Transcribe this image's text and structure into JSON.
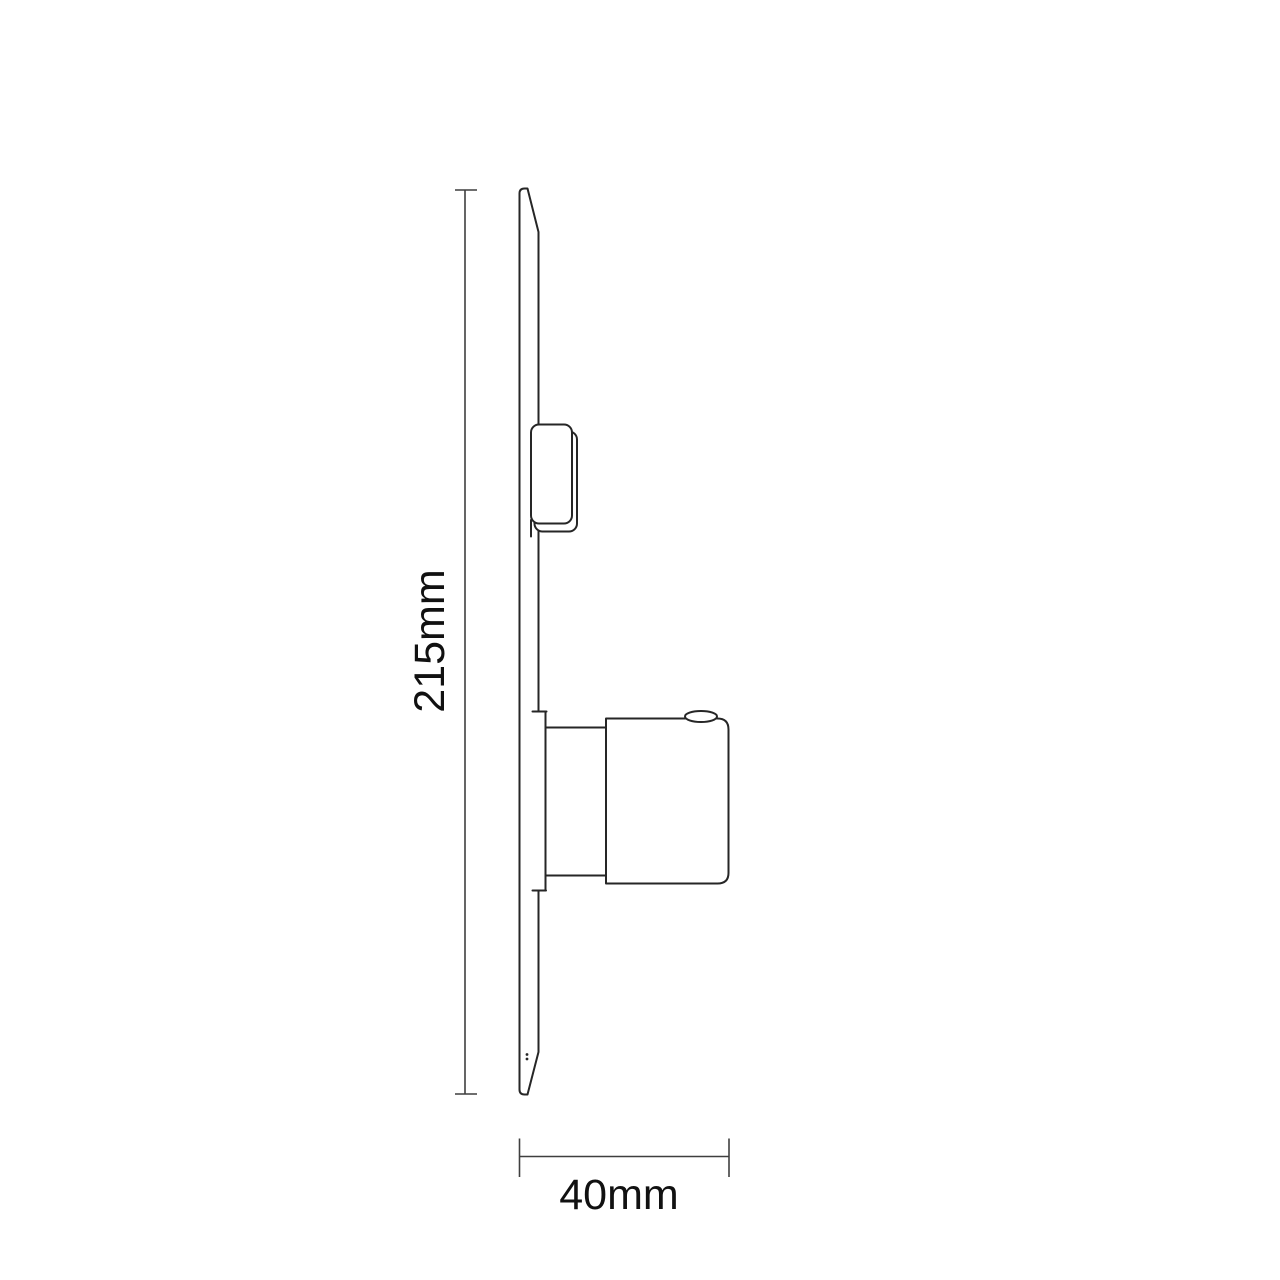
{
  "drawing": {
    "title": "side-profile technical drawing with dimensions",
    "labels": {
      "height": "215mm",
      "width": "40mm"
    },
    "colors": {
      "object_line": "#262626",
      "dimension_line": "#3f3f3f",
      "text": "#111111",
      "background": "#ffffff"
    }
  }
}
